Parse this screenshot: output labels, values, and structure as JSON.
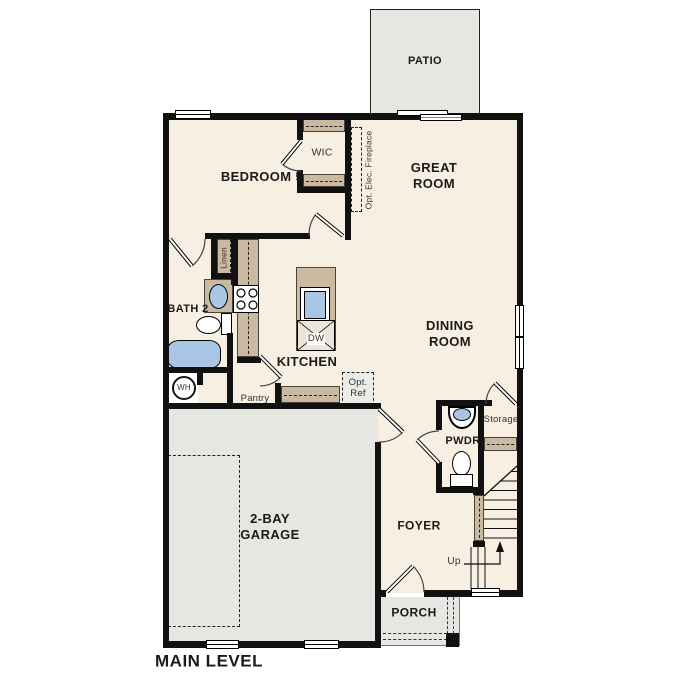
{
  "title": "MAIN LEVEL",
  "colors": {
    "floor": "#f7efe2",
    "outdoor": "#e6e6e3",
    "cabinet": "#c9baa1",
    "wall": "#111111",
    "fixture_blue": "#a9c7e5",
    "optional_fill": "#ebebe8"
  },
  "rooms": {
    "patio": "PATIO",
    "bedroom5": "BEDROOM 5",
    "wic": "WIC",
    "great_room": "GREAT\nROOM",
    "bath2": "BATH 2",
    "kitchen": "KITCHEN",
    "dining_room": "DINING\nROOM",
    "pwdr": "PWDR",
    "storage": "Storage",
    "garage": "2-BAY\nGARAGE",
    "foyer": "FOYER",
    "porch": "PORCH"
  },
  "annotations": {
    "fireplace": "Opt. Elec. Fireplace",
    "linen": "Linen",
    "pantry": "Pantry",
    "opt_ref": "Opt.\nRef",
    "dishwasher": "DW",
    "water_heater": "WH",
    "up": "Up"
  }
}
